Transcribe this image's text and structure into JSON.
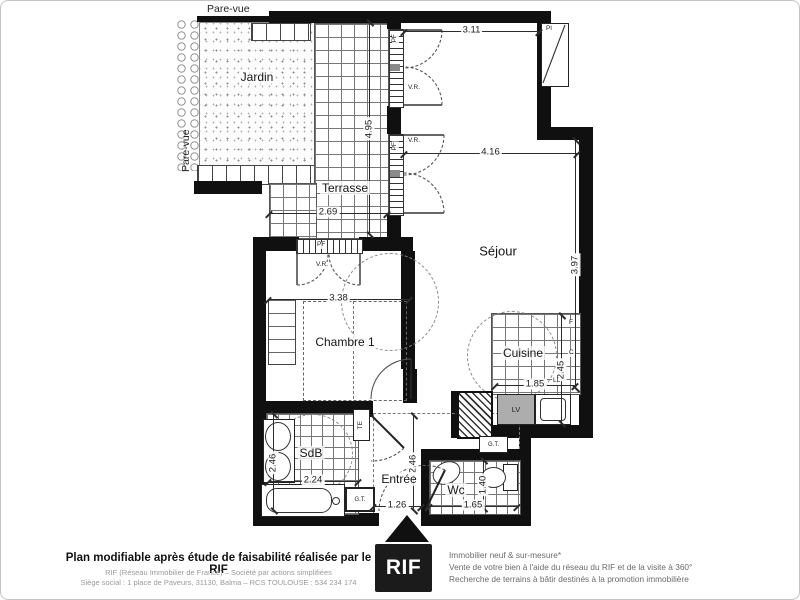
{
  "plan": {
    "rooms": {
      "jardin": "Jardin",
      "terrasse": "Terrasse",
      "sejour": "Séjour",
      "chambre": "Chambre 1",
      "cuisine": "Cuisine",
      "sdb": "SdB",
      "entree": "Entrée",
      "wc": "Wc"
    },
    "dims": {
      "terrasse_h": "4.95",
      "terrasse_w": "2.69",
      "sejour_top": "3.11",
      "sejour_w": "4.16",
      "sejour_h": "3.97",
      "chambre_w": "3.38",
      "cuisine_w": "1.85",
      "cuisine_h": "2.45",
      "sdb_h": "2.46",
      "sdb_w": "2.24",
      "entree_h": "2.46",
      "entree_w": "1.26",
      "wc_h": "1.40",
      "wc_w": "1.65"
    },
    "screens": {
      "top": "Pare-vue",
      "left": "Pare-vue"
    },
    "tags": {
      "pl": "Pl",
      "pf": "PF",
      "vr": "V.R.",
      "te": "TE",
      "gt": "G.T.",
      "lv": "LV",
      "f": "F",
      "c": "C",
      "ll": "LL"
    }
  },
  "footer": {
    "disclaimer": "Plan modifiable après étude de faisabilité réalisée par le RIF",
    "company_line1": "RIF (Réseau Immobilier de France) – Société par actions simplifiées",
    "company_line2": "Siège social : 1 place de Paveurs, 31130, Balma – RCS TOULOUSE : 534 234 174",
    "logo": "RIF",
    "services_line1": "Immobilier neuf & sur-mesure*",
    "services_line2": "Vente de votre bien à l'aide du réseau du RIF et de la visite à 360°",
    "services_line3": "Recherche de terrains à bâtir destinés à la promotion immobilière"
  }
}
